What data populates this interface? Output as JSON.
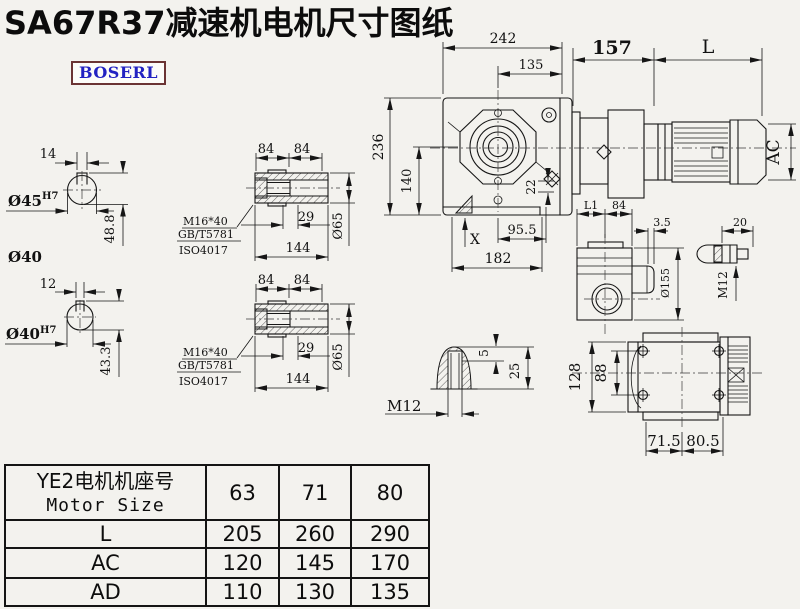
{
  "title": "SA67R37减速机电机尺寸图纸",
  "logo": "BOSERL",
  "shaft1": {
    "key_width": "14",
    "dia": "Ø45",
    "tol": "H7",
    "height": "48.8",
    "note": "Ø40"
  },
  "shaft2": {
    "key_width": "12",
    "dia": "Ø40",
    "tol": "H7",
    "height": "43.3"
  },
  "hollow_shaft_1": {
    "seg_a": "84",
    "seg_b": "84",
    "bolt": "M16*40",
    "std_gb": "GB/T5781",
    "std_iso": "ISO4017",
    "depth": "29",
    "length": "144",
    "dia": "Ø65"
  },
  "hollow_shaft_2": {
    "seg_a": "84",
    "seg_b": "84",
    "bolt": "M16*40",
    "std_gb": "GB/T5781",
    "std_iso": "ISO4017",
    "depth": "29",
    "length": "144",
    "dia": "Ø65"
  },
  "front_view": {
    "width_total": "242",
    "width_center": "135",
    "adapter_len": "157",
    "motor_len": "L",
    "motor_dia": "AC",
    "height_total": "236",
    "height_center": "140",
    "offset": "22",
    "surface_mark": "X",
    "foot_center": "95.5",
    "foot_width": "182"
  },
  "side_view": {
    "dim_l1": "L1",
    "dim_84": "84",
    "ear_thick": "3.5",
    "flange_dia": "Ø155",
    "stud_len": "20",
    "thread": "M12"
  },
  "bottom_view": {
    "height": "128",
    "bolt_span": "88",
    "left_half": "71.5",
    "right_half": "80.5"
  },
  "key_detail": {
    "thread": "M12",
    "key_height": "5",
    "depth": "25"
  },
  "table": {
    "header_cn": "YE2电机机座号",
    "header_en": "Motor Size",
    "sizes": [
      "63",
      "71",
      "80"
    ],
    "rows": [
      {
        "label": "L",
        "values": [
          "205",
          "260",
          "290"
        ]
      },
      {
        "label": "AC",
        "values": [
          "120",
          "145",
          "170"
        ]
      },
      {
        "label": "AD",
        "values": [
          "110",
          "130",
          "135"
        ]
      }
    ]
  }
}
